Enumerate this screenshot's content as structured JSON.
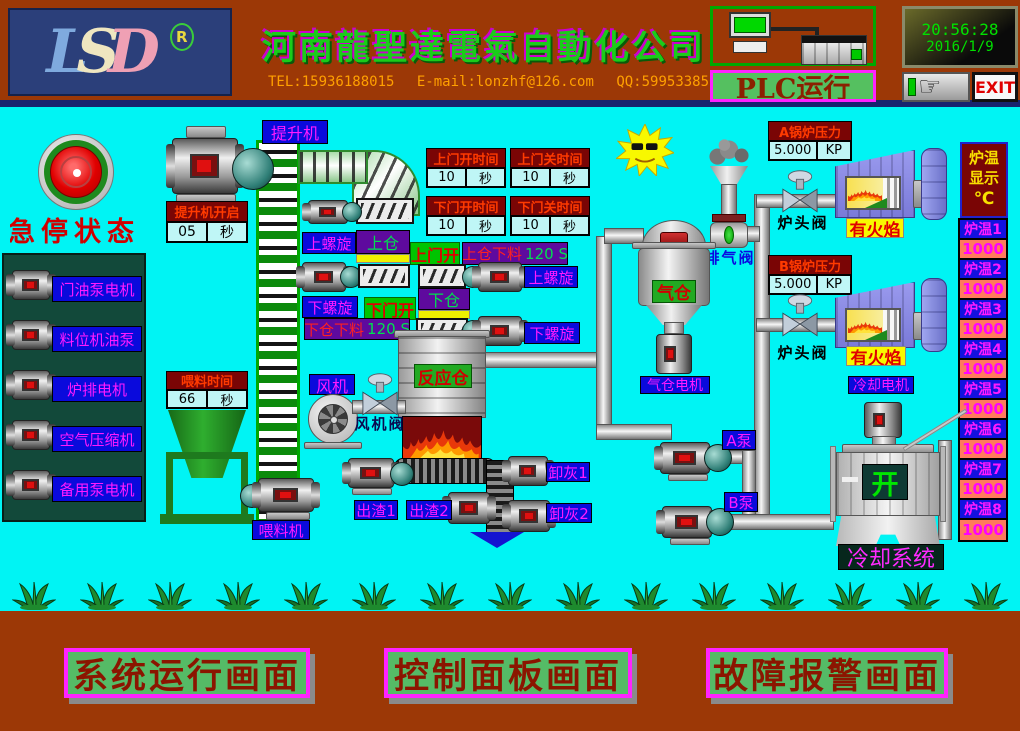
{
  "colors": {
    "screen_cyan": "#00F4F4",
    "frame_brown": "#9C3806",
    "accent_magenta": "#FF00FF",
    "label_blue": "#0A0ADC",
    "alarm_dark_red": "#7A0505",
    "button_green": "#55BB66",
    "status_green": "#00C400"
  },
  "header": {
    "logo": {
      "l": "L",
      "s": "S",
      "d": "D",
      "reg": "R"
    },
    "company": "河南龍聖達電氣自動化公司",
    "tel": "TEL:15936188015",
    "email": "E-mail:lonzhf@126.com",
    "qq": "QQ:599533856",
    "plc_status": "PLC运行",
    "time": "20:56:28",
    "date": "2016/1/9",
    "exit": "EXIT"
  },
  "estop": {
    "label": "急停状态"
  },
  "motor_panel": {
    "motors": [
      "门油泵电机",
      "料位机油泵",
      "炉排电机",
      "空气压缩机",
      "备用泵电机"
    ]
  },
  "lift": {
    "label": "提升机",
    "timer_title": "提升机开启",
    "timer_value": "05",
    "timer_unit": "秒"
  },
  "door_timers": [
    {
      "title": "上门开时间",
      "value": "10",
      "unit": "秒"
    },
    {
      "title": "上门关时间",
      "value": "10",
      "unit": "秒"
    },
    {
      "title": "下门开时间",
      "value": "10",
      "unit": "秒"
    },
    {
      "title": "下门关时间",
      "value": "10",
      "unit": "秒"
    }
  ],
  "process": {
    "upper_screw": "上螺旋",
    "upper_bin": "上仓",
    "upper_door_open": "上门开",
    "upper_discharge": "上仓下料",
    "upper_discharge_time": "120 S",
    "lower_screw": "下螺旋",
    "lower_bin": "下仓",
    "lower_door_open": "下门开",
    "lower_discharge": "下仓下料",
    "lower_discharge_time": "120 S",
    "reactor": "反应仓",
    "fan": "风机",
    "fan_valve": "风机阀",
    "gas_bin": "气仓",
    "gas_motor": "气仓电机",
    "exhaust_valve": "排气阀"
  },
  "feed": {
    "timer_title": "喂料时间",
    "timer_value": "66",
    "timer_unit": "秒",
    "feeder_label": "喂料机"
  },
  "conveyor": {
    "slag1": "出渣1",
    "slag2": "出渣2",
    "ash1": "卸灰1",
    "ash2": "卸灰2"
  },
  "boilers": {
    "a_title": "A锅炉压力",
    "a_value": "5.000",
    "a_unit": "KP",
    "b_title": "B锅炉压力",
    "b_value": "5.000",
    "b_unit": "KP",
    "head_valve": "炉头阀",
    "flame_status": "有火焰",
    "cooling_motor": "冷却电机"
  },
  "pumps": {
    "a": "A泵",
    "b": "B泵"
  },
  "cooling": {
    "status": "开",
    "label": "冷却系统"
  },
  "temps": {
    "title_line1": "炉温",
    "title_line2": "显示",
    "unit": "℃",
    "rows": [
      {
        "label": "炉温1",
        "value": "1000"
      },
      {
        "label": "炉温2",
        "value": "1000"
      },
      {
        "label": "炉温3",
        "value": "1000"
      },
      {
        "label": "炉温4",
        "value": "1000"
      },
      {
        "label": "炉温5",
        "value": "1000"
      },
      {
        "label": "炉温6",
        "value": "1000"
      },
      {
        "label": "炉温7",
        "value": "1000"
      },
      {
        "label": "炉温8",
        "value": "1000"
      }
    ]
  },
  "footer": {
    "buttons": [
      "系统运行画面",
      "控制面板画面",
      "故障报警画面"
    ]
  }
}
